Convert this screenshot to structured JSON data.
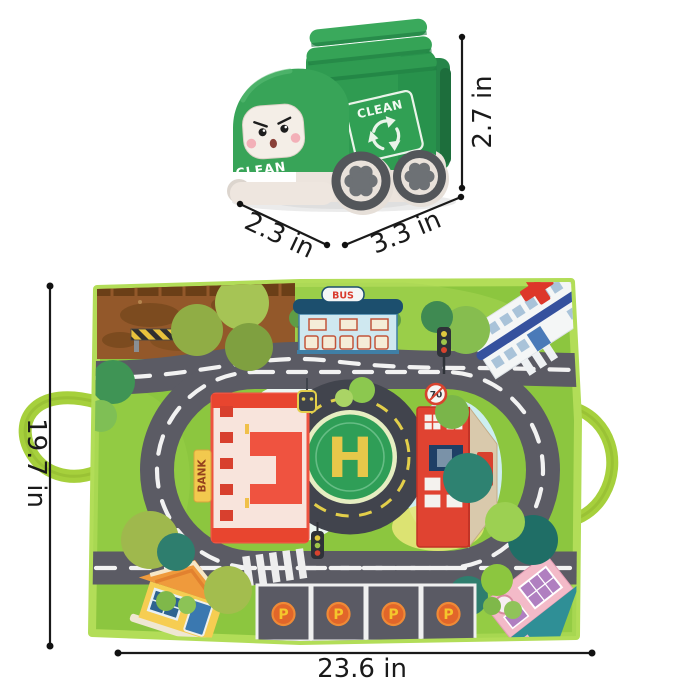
{
  "truck": {
    "front_label": "CLEAN",
    "panel_label": "CLEAN"
  },
  "truck_dimensions": {
    "height": "2.7 in",
    "width": "2.3 in",
    "length": "3.3 in"
  },
  "mat": {
    "bus_sign": "BUS",
    "bank_sign": "BANK",
    "helipad_letter": "H",
    "parking_label": "P",
    "speed_limit": "70"
  },
  "mat_dimensions": {
    "height": "19.7 in",
    "width": "23.6 in"
  },
  "colors": {
    "truck_green": "#2f9b51",
    "truck_dark_green": "#1d6e3c",
    "cream": "#ece4dd",
    "wheel_gray": "#6d7175",
    "mat_green": "#8cc63f",
    "mat_edge_green": "#b2dd58",
    "road_gray": "#5b5b64",
    "helipad_green": "#2f9e57",
    "helipad_yellow": "#e7c84a",
    "bank_red": "#e8452f",
    "parking_orange": "#e2662a",
    "dimension_line": "#1a1a1a"
  }
}
